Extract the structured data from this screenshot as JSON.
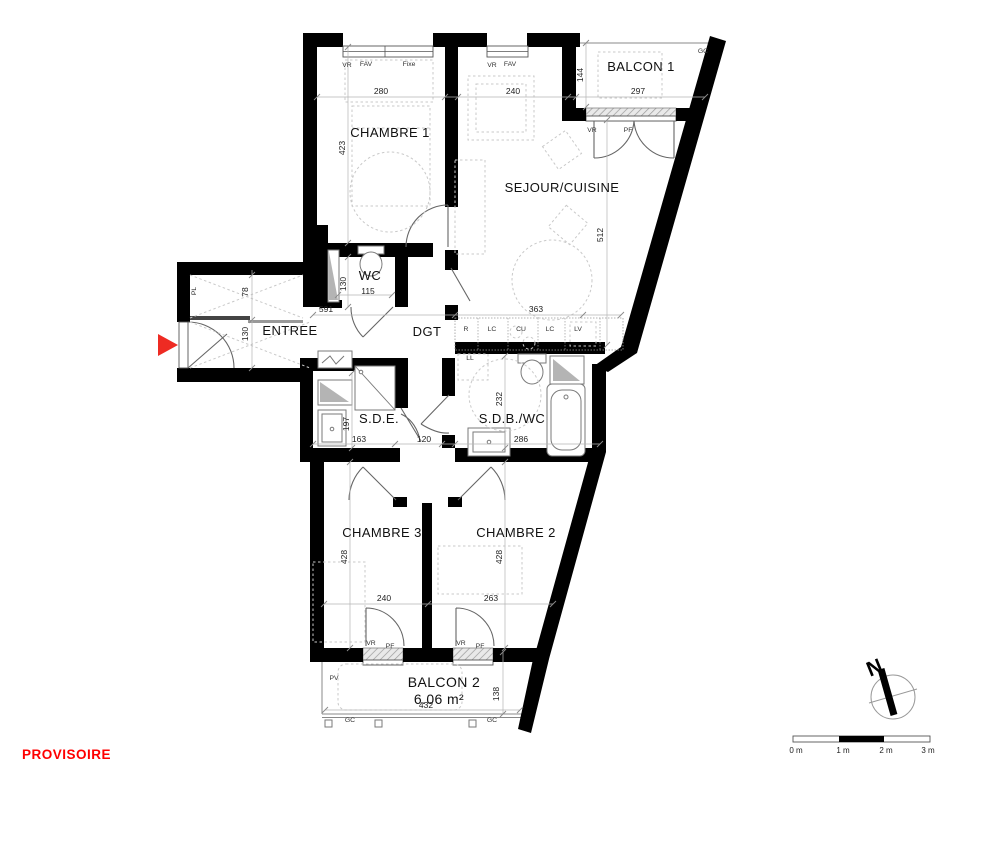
{
  "stamp": {
    "text": "PROVISOIRE"
  },
  "colors": {
    "wall": "#000000",
    "stamp_red": "#ff0000",
    "arrow_red": "#ee2b23",
    "furniture_gray": "#c9c9c9",
    "duct_gray": "#b4b4b4"
  },
  "rooms": {
    "chambre1": {
      "label": "CHAMBRE 1",
      "width": "280",
      "height": "423"
    },
    "sejour_cuisine": {
      "label": "SEJOUR/CUISINE",
      "width_top": "240",
      "height": "512",
      "width_bottom": "363"
    },
    "balcon1": {
      "label": "BALCON 1",
      "width": "297",
      "depth": "144"
    },
    "wc": {
      "label": "WC",
      "width": "115",
      "height": "130"
    },
    "entree": {
      "label": "ENTREE",
      "height": "130",
      "corridor_length": "591"
    },
    "closet": {
      "label": "PL",
      "depth": "78"
    },
    "dgt": {
      "label": "DGT",
      "width": "120"
    },
    "sde": {
      "label": "S.D.E.",
      "width": "163",
      "height": "197"
    },
    "sdb_wc": {
      "label": "S.D.B./WC",
      "width": "286",
      "height": "232"
    },
    "chambre3": {
      "label": "CHAMBRE 3",
      "width": "240",
      "height": "428"
    },
    "chambre2": {
      "label": "CHAMBRE 2",
      "width": "263",
      "height": "428"
    },
    "balcon2": {
      "label": "BALCON 2",
      "area": "6.06 m²",
      "width": "432",
      "depth": "138"
    }
  },
  "tags": {
    "vr": "VR",
    "fav": "FAV",
    "fixe": "Fixe",
    "pf": "PF",
    "gc": "GC",
    "pv": "PV",
    "ll": "LL"
  },
  "kitchen": {
    "units": [
      "R",
      "LC",
      "CU",
      "LC",
      "LV"
    ]
  },
  "compass": {
    "north": "N"
  },
  "scalebar": {
    "labels": [
      "0 m",
      "1 m",
      "2 m",
      "3 m"
    ]
  }
}
